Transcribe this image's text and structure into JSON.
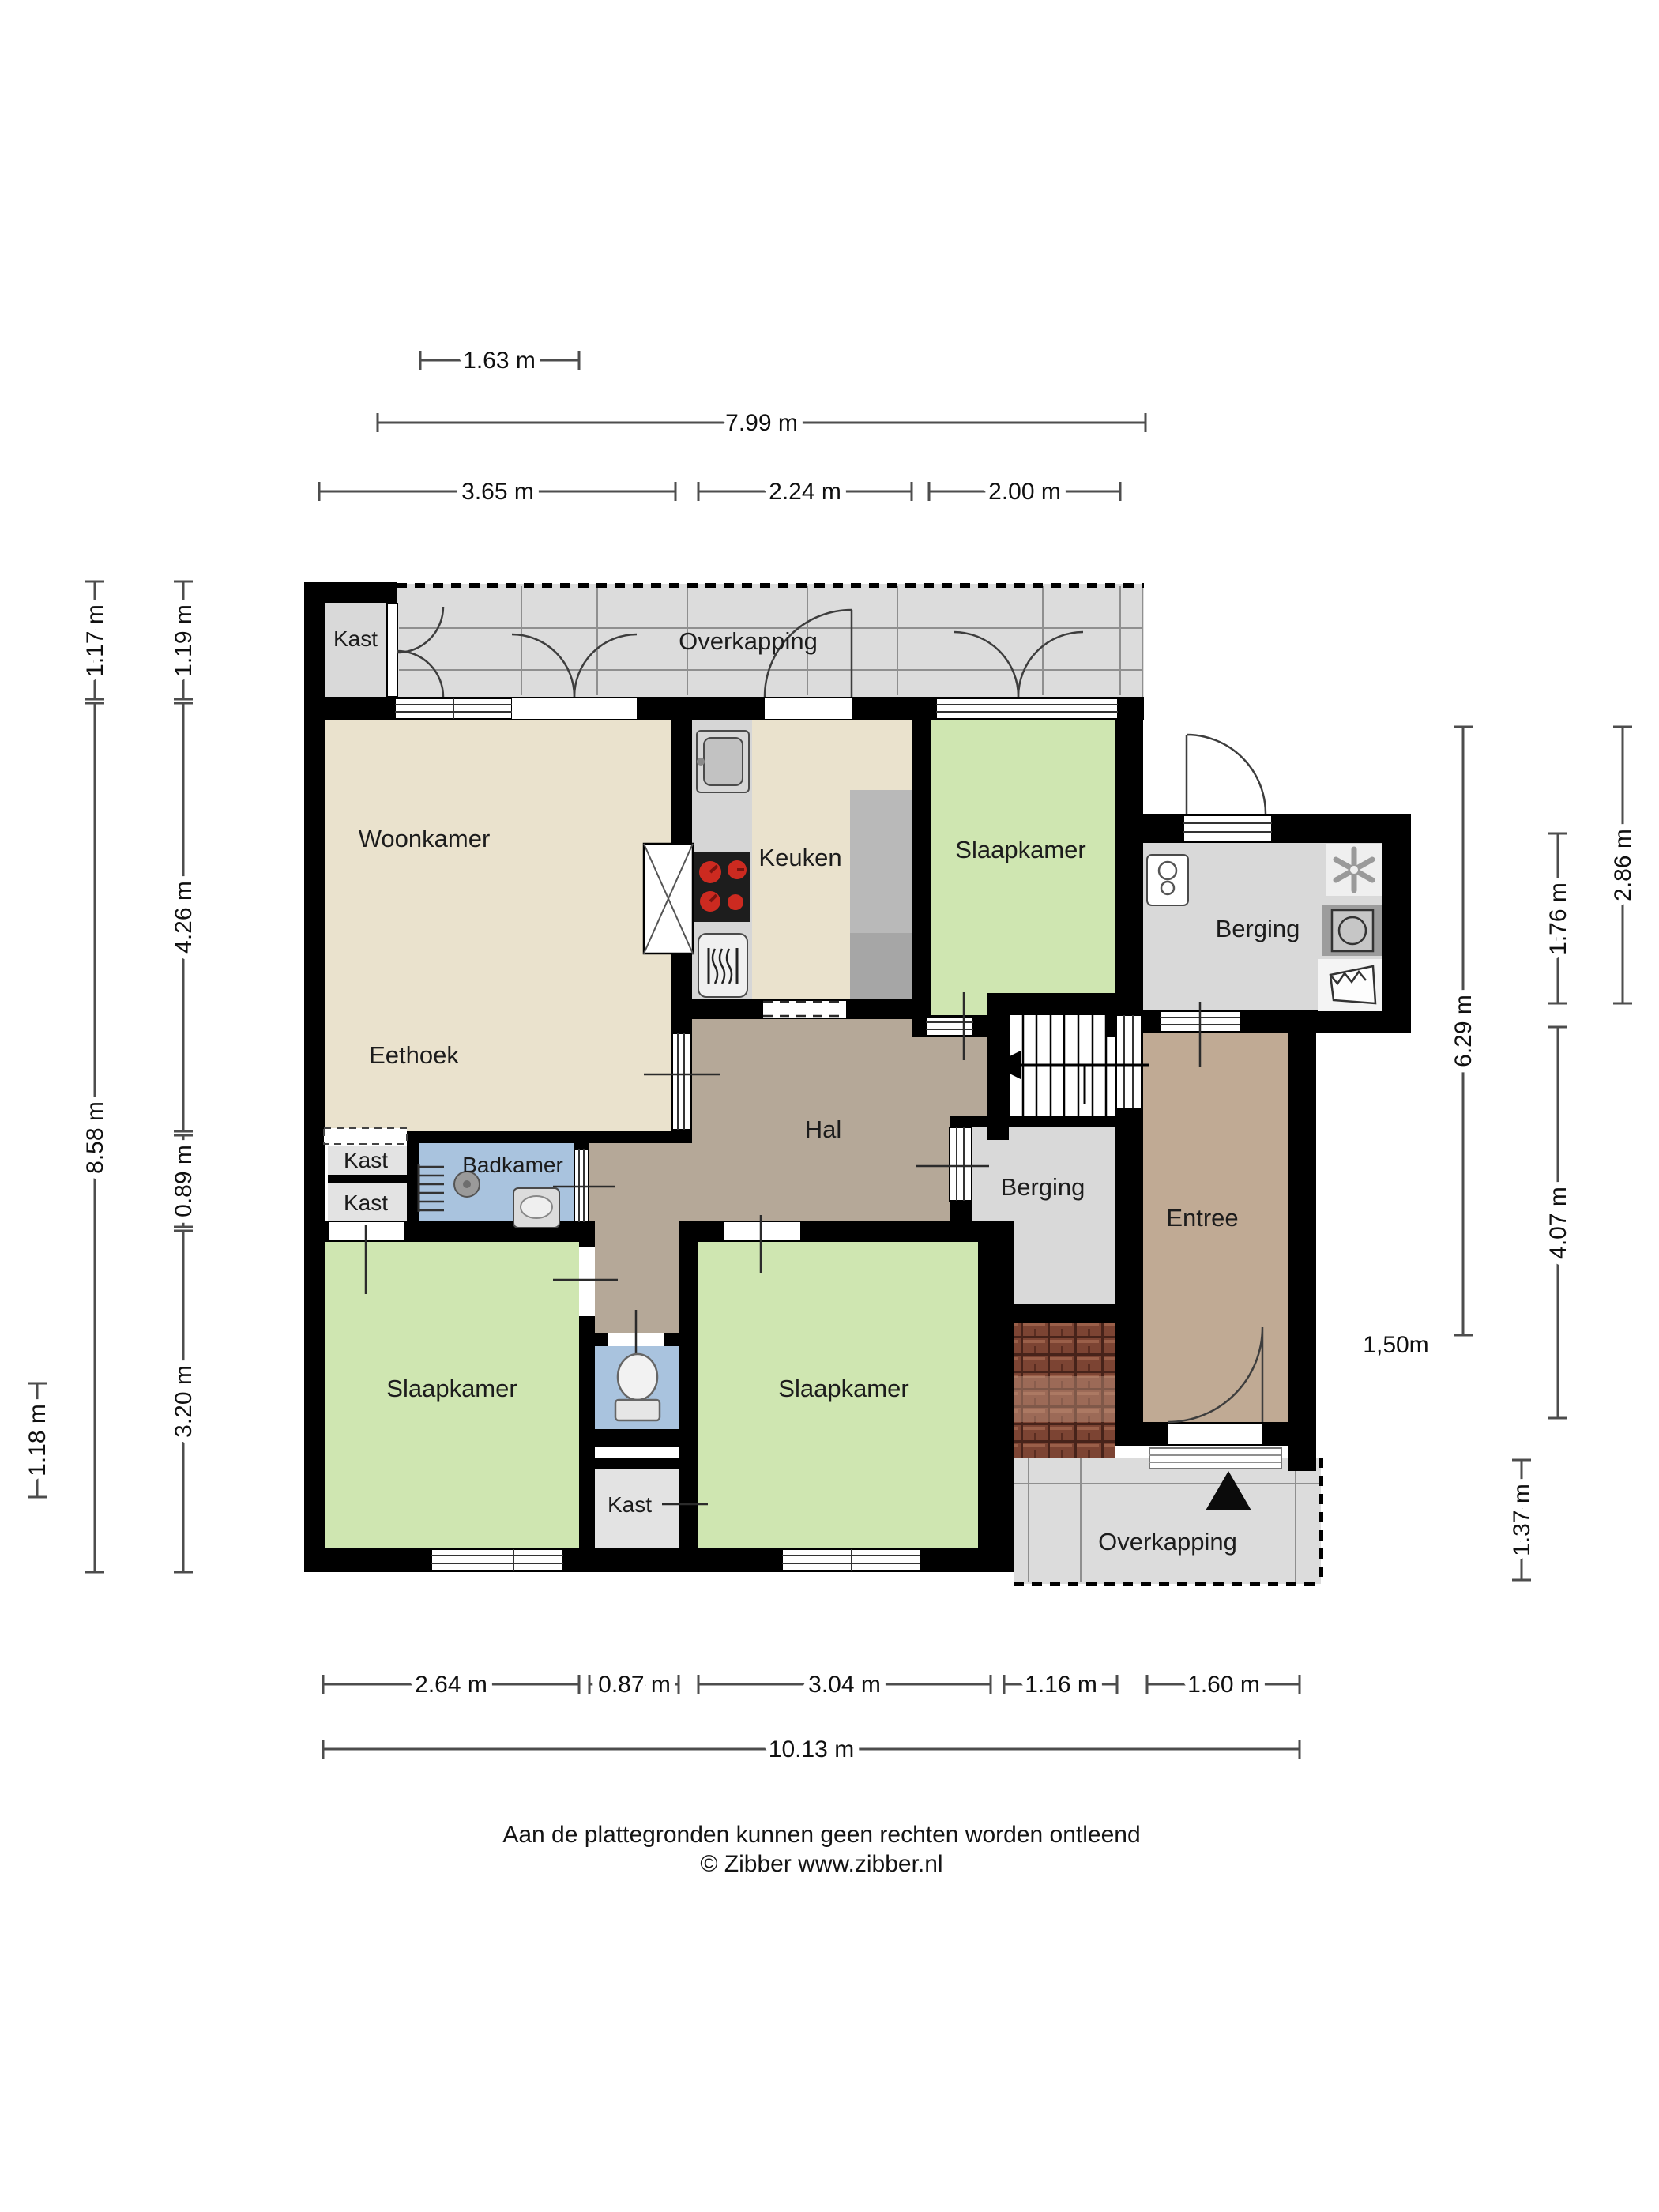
{
  "rooms": {
    "kast_tl": "Kast",
    "overkapping_top": "Overkapping",
    "woonkamer": "Woonkamer",
    "keuken": "Keuken",
    "slaapkamer_tr": "Slaapkamer",
    "berging_ext": "Berging",
    "eethoek": "Eethoek",
    "hal": "Hal",
    "badkamer": "Badkamer",
    "kast_1": "Kast",
    "kast_2": "Kast",
    "berging_inner": "Berging",
    "entree": "Entree",
    "slaapkamer_bl": "Slaapkamer",
    "slaapkamer_bm": "Slaapkamer",
    "kast_bottom": "Kast",
    "overkapping_br": "Overkapping"
  },
  "annotations": {
    "height_note": "1,50m"
  },
  "dimensions": {
    "top": [
      "1.63 m",
      "7.99 m",
      "3.65 m",
      "2.24 m",
      "2.00 m"
    ],
    "bottom": [
      "2.64 m",
      "0.87 m",
      "3.04 m",
      "1.16 m",
      "1.60 m",
      "10.13 m"
    ],
    "left": [
      "1.17 m",
      "1.19 m",
      "4.26 m",
      "8.58 m",
      "0.89 m",
      "3.20 m",
      "1.18 m"
    ],
    "right": [
      "2.86 m",
      "1.76 m",
      "6.29 m",
      "4.07 m",
      "1.37 m"
    ]
  },
  "footer": {
    "disclaimer": "Aan de plattegronden kunnen geen rechten worden ontleend",
    "copyright": "© Zibber www.zibber.nl"
  },
  "colors": {
    "wall": "#000000",
    "living": "#eae2cd",
    "bedroom": "#cfe6b1",
    "hall": "#b5a898",
    "entry": "#c0aa94",
    "bath": "#a9c3de",
    "storage": "#d9d9d9",
    "closet": "#e3e3e3",
    "canopy": "#dcdcdc",
    "counter": "#d6d6d6",
    "brick": "#7c4433",
    "burner": "#cc2a20"
  },
  "icons": [
    "sink-icon",
    "stove-icon",
    "oven-icon",
    "refrigerator-column",
    "pass-through-icon",
    "shower-icon",
    "towel-radiator-icon",
    "washbasin-icon",
    "toilet-icon",
    "boiler-icon",
    "ventilation-fan-icon",
    "washing-machine-icon",
    "laundry-basket-icon",
    "stairs-icon",
    "stairs-direction-arrow-icon",
    "entrance-triangle-icon"
  ]
}
